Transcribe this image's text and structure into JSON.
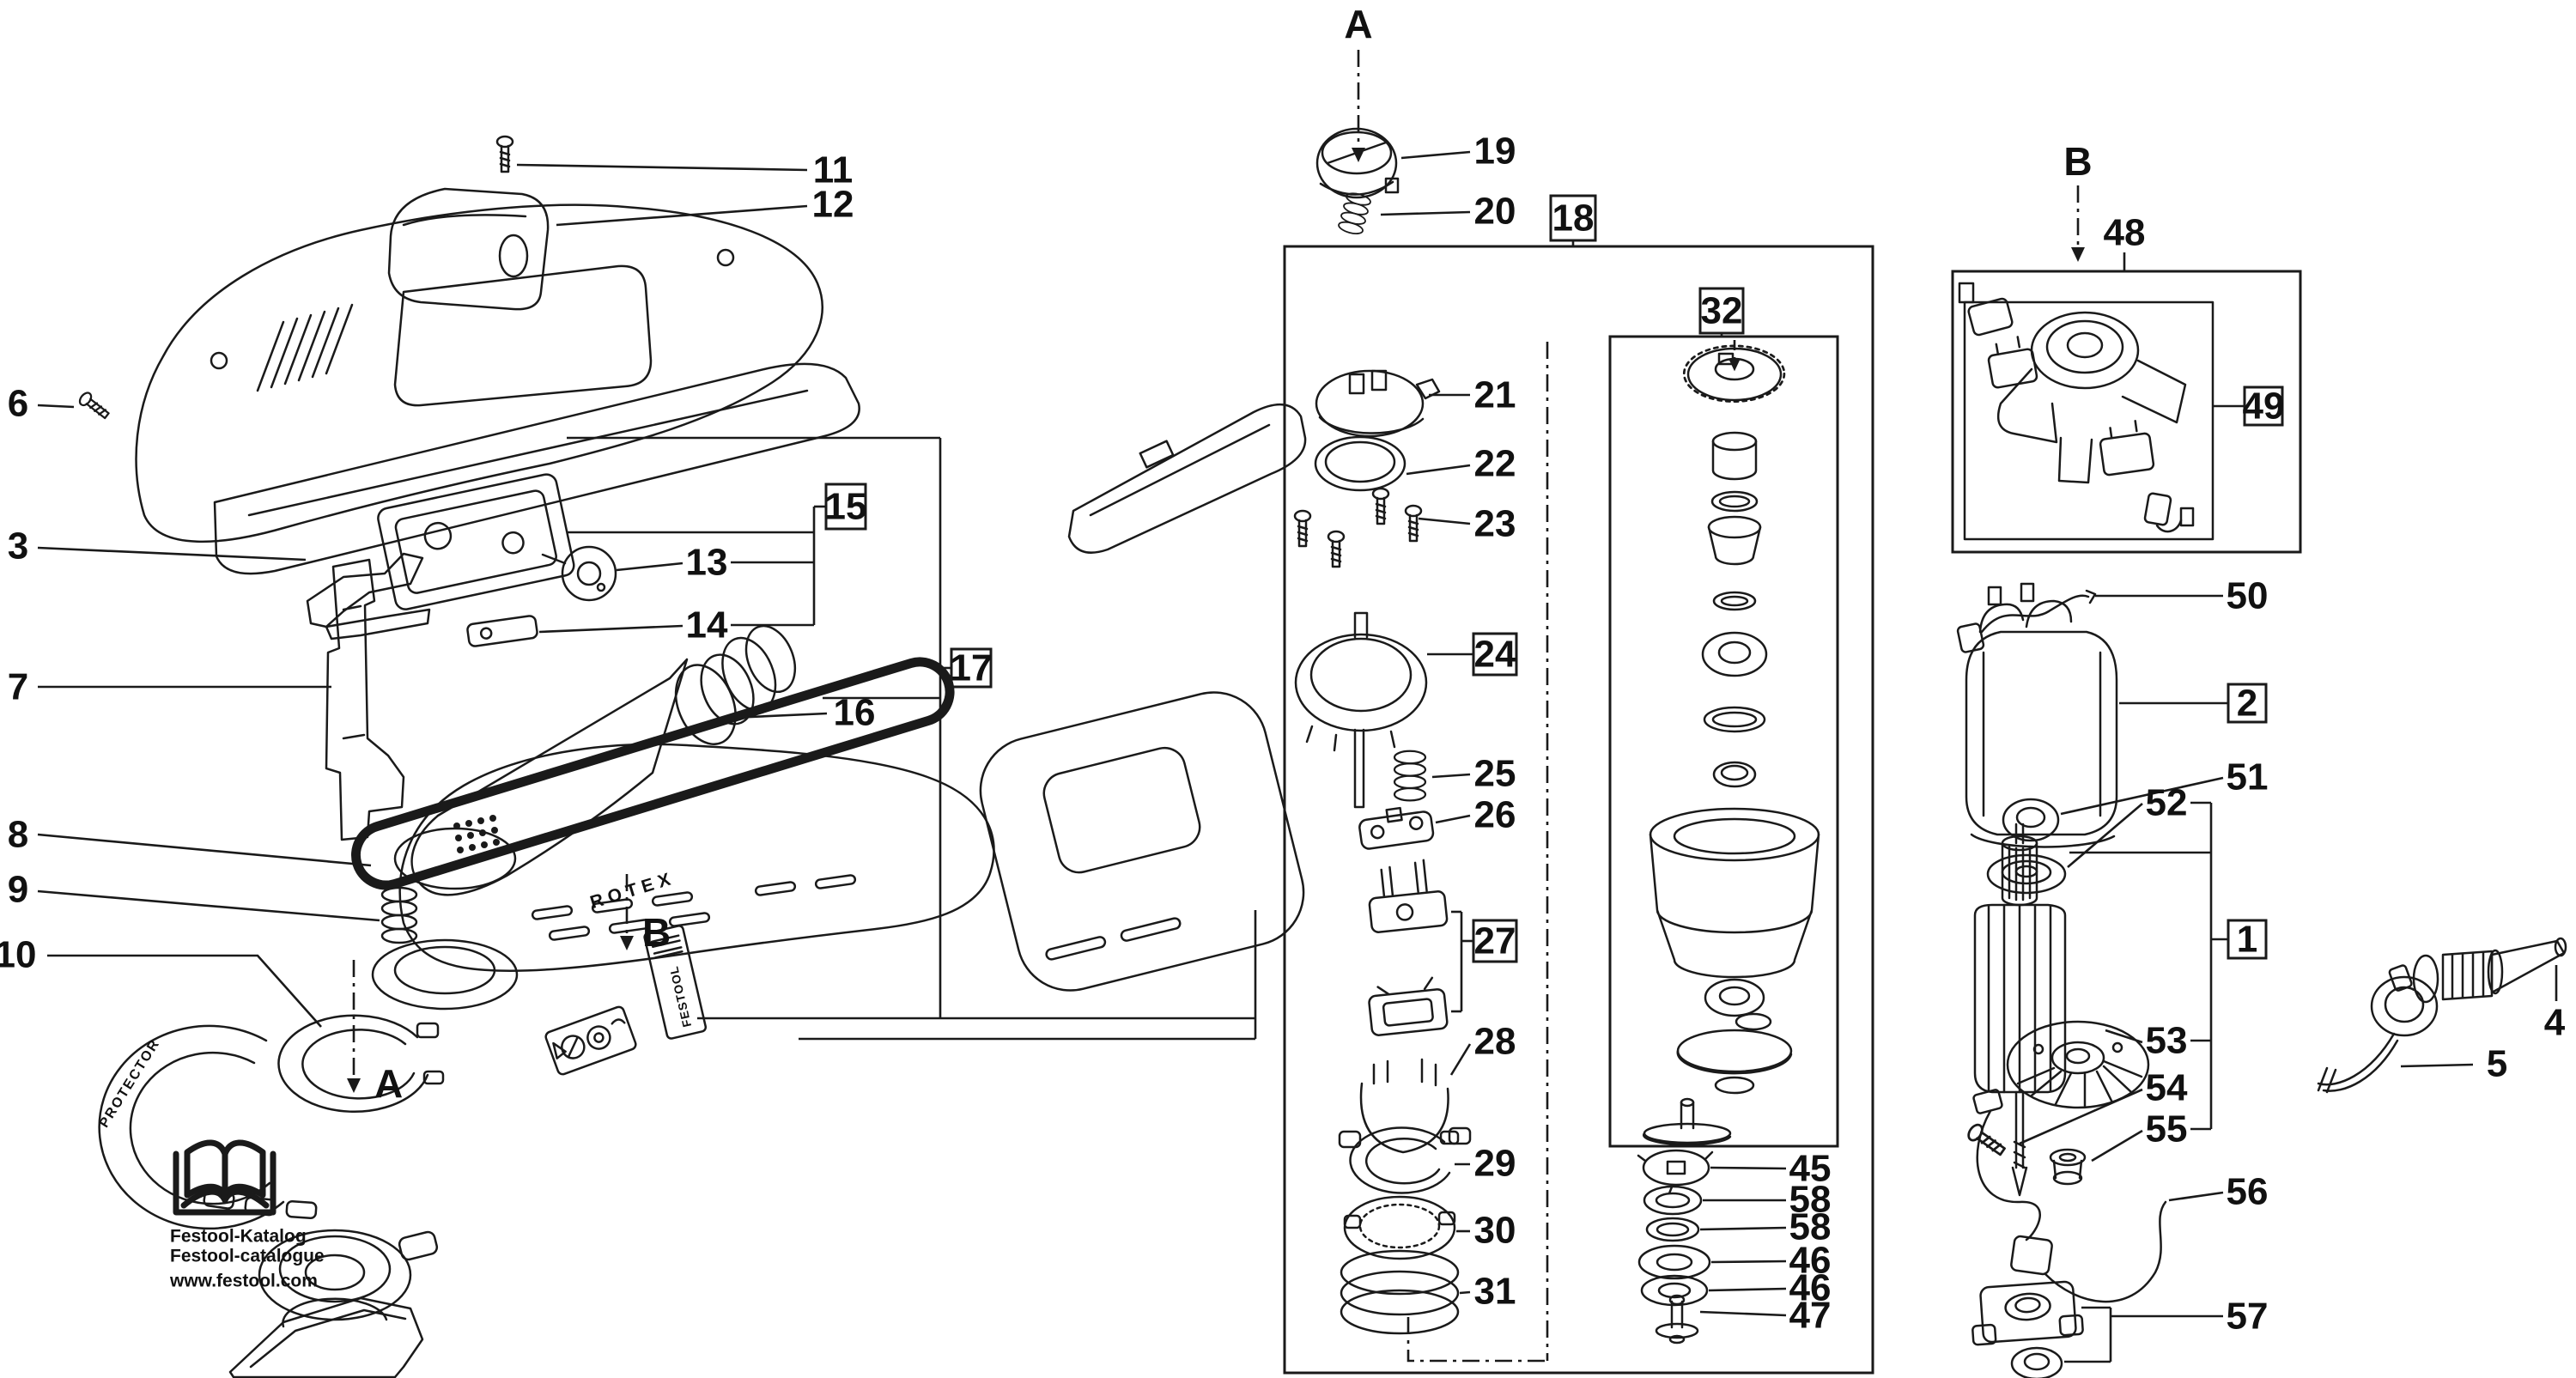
{
  "labels": {
    "l1": "1",
    "l2": "2",
    "l3": "3",
    "l4": "4",
    "l5": "5",
    "l6": "6",
    "l7": "7",
    "l8": "8",
    "l9": "9",
    "l10": "10",
    "l11": "11",
    "l12": "12",
    "l13": "13",
    "l14": "14",
    "l15": "15",
    "l16": "16",
    "l17": "17",
    "l18": "18",
    "l19": "19",
    "l20": "20",
    "l21": "21",
    "l22": "22",
    "l23": "23",
    "l24": "24",
    "l25": "25",
    "l26": "26",
    "l27": "27",
    "l28": "28",
    "l29": "29",
    "l30": "30",
    "l31": "31",
    "l32": "32",
    "l45": "45",
    "l46a": "46",
    "l46b": "46",
    "l47": "47",
    "l48": "48",
    "l49": "49",
    "l50": "50",
    "l51": "51",
    "l52": "52",
    "l53": "53",
    "l54": "54",
    "l55": "55",
    "l56": "56",
    "l57": "57",
    "l58a": "58",
    "l58b": "58"
  },
  "letters": {
    "top_a": "A",
    "top_b": "B",
    "side_a": "A",
    "side_b": "B"
  },
  "branding": {
    "katalog": "Festool-Katalog",
    "catalogue": "Festool-catalogue",
    "website": "www.festool.com",
    "rotex": "ROTEX",
    "protector": "PROTECTOR",
    "festool": "FESTOOL"
  },
  "colors": {
    "ink": "#1a1a1a",
    "background": "#ffffff"
  }
}
